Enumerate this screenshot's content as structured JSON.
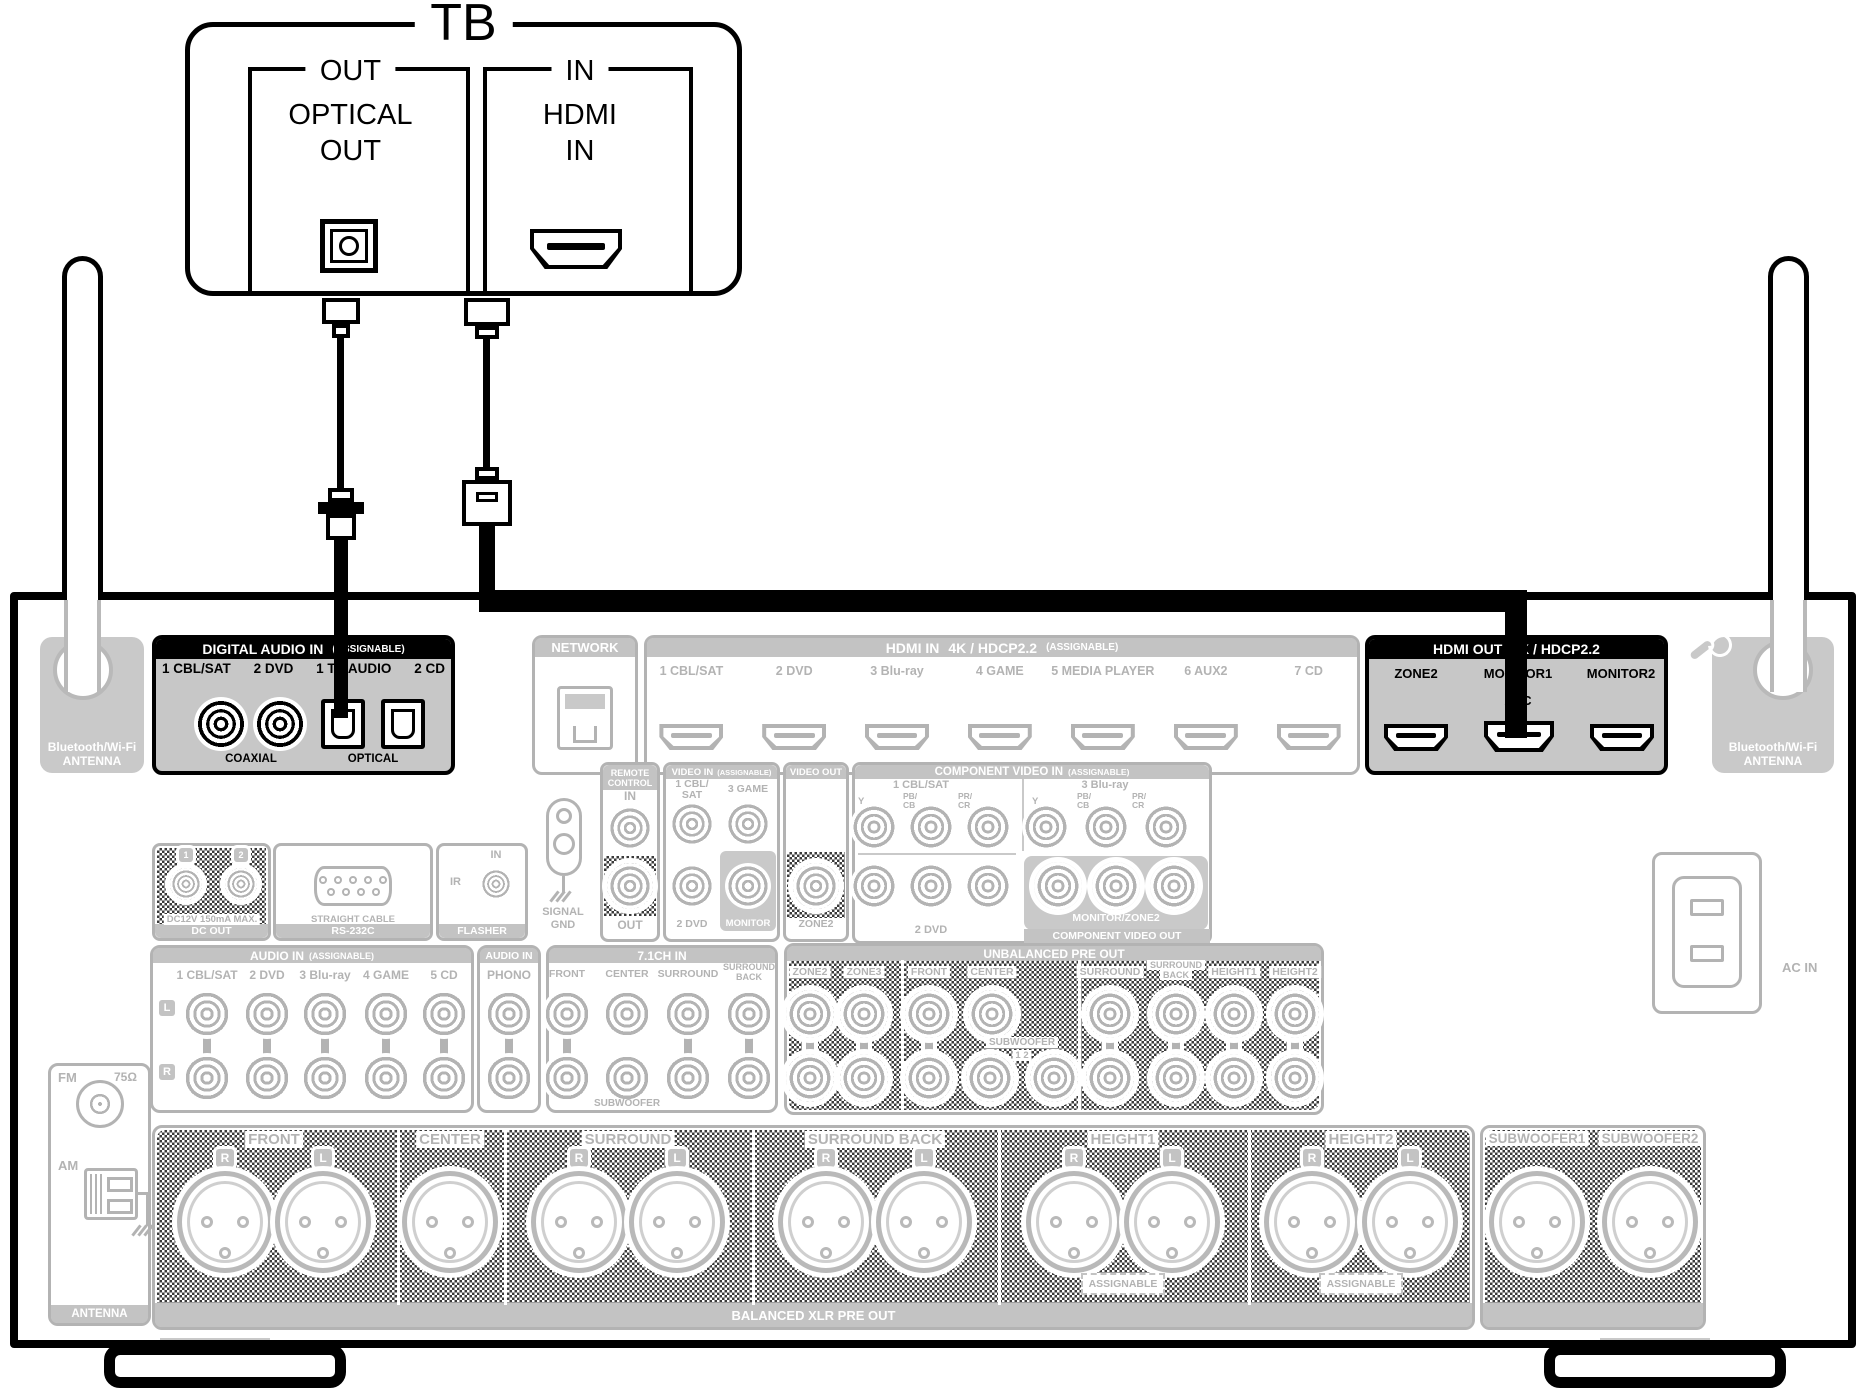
{
  "tv": {
    "title": "TB",
    "out_group": "OUT",
    "optical_line1": "OPTICAL",
    "optical_line2": "OUT",
    "in_group": "IN",
    "hdmi_line1": "HDMI",
    "hdmi_line2": "IN"
  },
  "digital_audio_in": {
    "header": "DIGITAL AUDIO IN",
    "note": "(ASSIGNABLE)",
    "ports": [
      "1 CBL/SAT",
      "2 DVD",
      "1 TV AUDIO",
      "2 CD"
    ],
    "coaxial": "COAXIAL",
    "optical": "OPTICAL"
  },
  "network": {
    "header": "NETWORK"
  },
  "hdmi_in": {
    "header": "HDMI IN",
    "spec": "4K / HDCP2.2",
    "note": "(ASSIGNABLE)",
    "ports": [
      "1 CBL/SAT",
      "2 DVD",
      "3 Blu-ray",
      "4 GAME",
      "5 MEDIA PLAYER",
      "6 AUX2",
      "7 CD"
    ]
  },
  "hdmi_out": {
    "header": "HDMI OUT",
    "spec": "4K / HDCP2.2",
    "zone2": "ZONE2",
    "monitor1": "MONITOR1",
    "monitor2": "MONITOR2",
    "arc": "ARC"
  },
  "bt": {
    "line1": "Bluetooth/Wi-Fi",
    "line2": "ANTENNA"
  },
  "remote": {
    "h1": "REMOTE",
    "h2": "CONTROL",
    "in": "IN",
    "out": "OUT"
  },
  "gnd": {
    "l1": "SIGNAL",
    "l2": "GND"
  },
  "video_in": {
    "header": "VIDEO IN",
    "note": "(ASSIGNABLE)",
    "cbl1": "1 CBL/",
    "cbl2": "SAT",
    "game": "3 GAME",
    "dvd": "2 DVD",
    "monitor": "MONITOR"
  },
  "video_out": {
    "header": "VIDEO OUT",
    "zone2": "ZONE2"
  },
  "comp": {
    "header": "COMPONENT VIDEO IN",
    "note": "(ASSIGNABLE)",
    "g1": "1 CBL/SAT",
    "g2": "3 Blu-ray",
    "g3": "2 DVD",
    "y": "Y",
    "pb": "PB/",
    "cb": "CB",
    "pr": "PR/",
    "cr": "CR",
    "out_label": "MONITOR/ZONE2",
    "out_header": "COMPONENT VIDEO OUT"
  },
  "dc": {
    "n1": "1",
    "n2": "2",
    "spec": "DC12V 150mA MAX.",
    "header": "DC OUT"
  },
  "rs232c": {
    "spec": "STRAIGHT CABLE",
    "header": "RS-232C"
  },
  "flasher": {
    "in": "IN",
    "ir": "IR",
    "header": "FLASHER"
  },
  "audio_in": {
    "header": "AUDIO IN",
    "note": "(ASSIGNABLE)",
    "ports": [
      "1 CBL/SAT",
      "2 DVD",
      "3 Blu-ray",
      "4 GAME",
      "5 CD"
    ],
    "l": "L",
    "r": "R"
  },
  "phono": {
    "header": "AUDIO IN",
    "label": "PHONO"
  },
  "ch71": {
    "header": "7.1CH IN",
    "front": "FRONT",
    "center": "CENTER",
    "surround": "SURROUND",
    "sb1": "SURROUND",
    "sb2": "BACK",
    "subwoofer": "SUBWOOFER"
  },
  "unbal": {
    "header": "UNBALANCED PRE OUT",
    "zone2": "ZONE2",
    "zone3": "ZONE3",
    "front": "FRONT",
    "center": "CENTER",
    "surround": "SURROUND",
    "sb1": "SURROUND",
    "sb2": "BACK",
    "height1": "HEIGHT1",
    "height2": "HEIGHT2",
    "subwoofer": "SUBWOOFER",
    "subnums": "1 2"
  },
  "tuner": {
    "fm": "FM",
    "ohm": "75Ω",
    "am": "AM",
    "antenna": "ANTENNA"
  },
  "xlr": {
    "front": "FRONT",
    "center": "CENTER",
    "surround": "SURROUND",
    "surround_back": "SURROUND BACK",
    "height1": "HEIGHT1",
    "height2": "HEIGHT2",
    "sub1": "SUBWOOFER1",
    "sub2": "SUBWOOFER2",
    "r": "R",
    "l": "L",
    "assignable": "ASSIGNABLE",
    "footer": "BALANCED XLR PRE OUT"
  },
  "ac": {
    "label": "AC IN"
  },
  "colors": {
    "highlight_header": "#000000",
    "inactive": "#b3b3b3",
    "panel_gray": "#c7c7c7"
  }
}
